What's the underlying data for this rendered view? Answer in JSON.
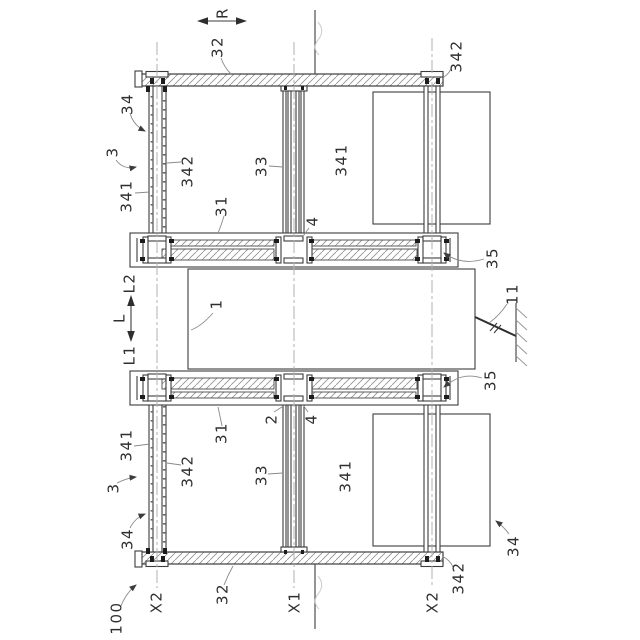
{
  "figure_labels": {
    "direction": "R",
    "beam": "32",
    "hanger_rod": "342",
    "hanger": "34",
    "panel_assembly": "3",
    "panel": "341",
    "post": "33",
    "rail": "31",
    "joint": "4",
    "roller": "35",
    "base_body": "1",
    "anchor": "11",
    "carriage": "2",
    "apparatus": "100",
    "axis_x1": "X1",
    "axis_x2": "X2",
    "length": "L",
    "length_upper": "L2",
    "length_lower": "L1"
  },
  "colors": {
    "line": "#3c3c3c",
    "hatch": "#8f8f8f",
    "centerline": "#b0b0b0",
    "leader": "#8a8a8a",
    "label": "#2f2f2f",
    "background": "#ffffff"
  }
}
